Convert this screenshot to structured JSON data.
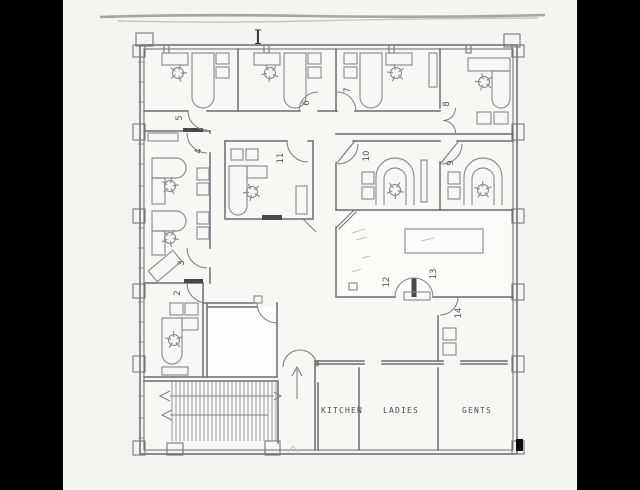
{
  "page": {
    "background_color": "#000000",
    "paper_color": "#f5f4f0",
    "ink_color": "#676d73",
    "bright_room_color": "#fefefe"
  },
  "plan": {
    "top_marker": "I",
    "room_numbers": {
      "n2": "2",
      "n3": "3",
      "n4": "4",
      "n5": "5",
      "n6": "6",
      "n7": "7",
      "n8": "8",
      "n9": "9",
      "n10": "10",
      "n11": "11",
      "n12": "12",
      "n13": "13",
      "n14": "14"
    },
    "room_labels": {
      "kitchen": "KITCHEN",
      "ladies": "LADIES",
      "gents": "GENTS"
    }
  }
}
